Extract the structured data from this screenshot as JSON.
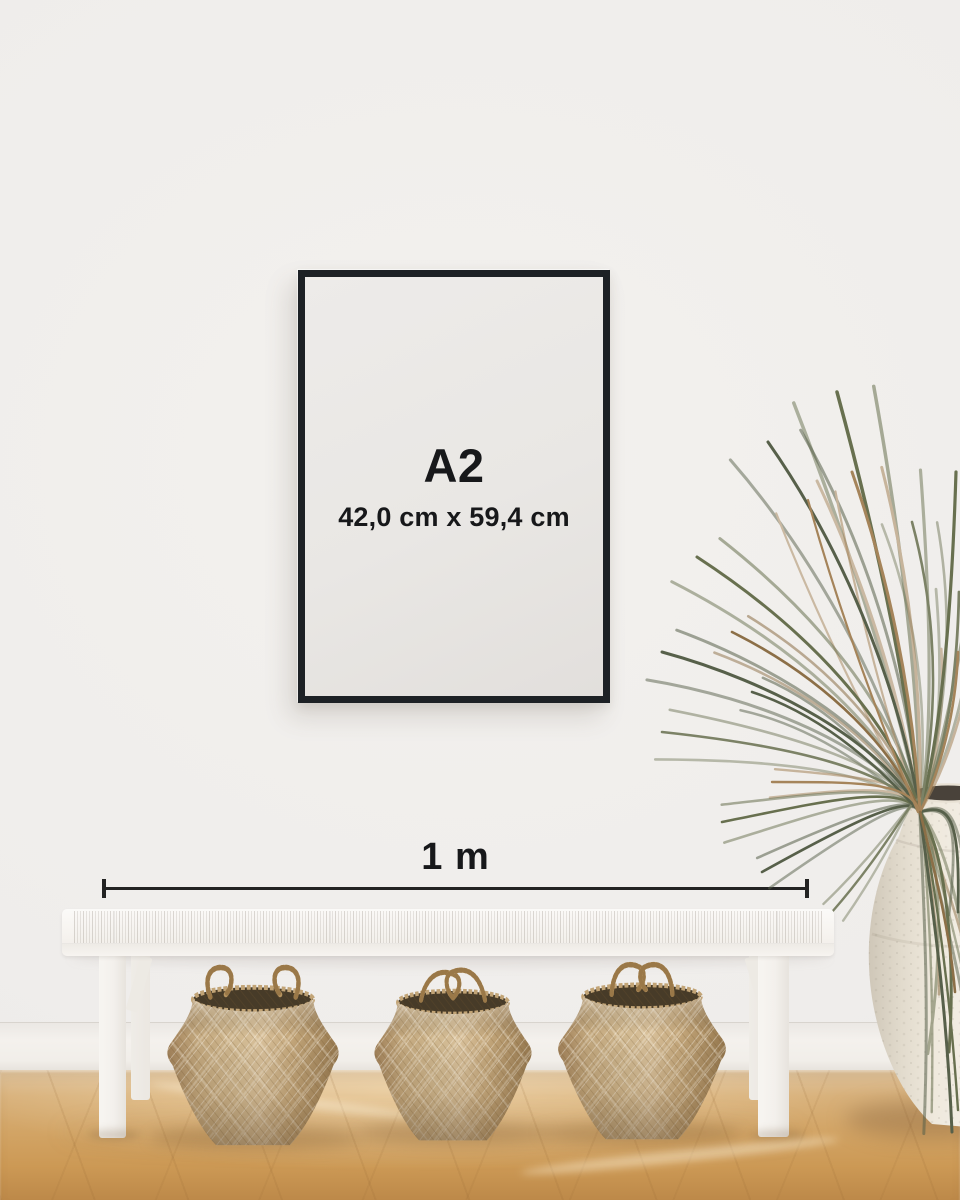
{
  "poster": {
    "size_label": "A2",
    "dimensions_label": "42,0 cm x 59,4 cm"
  },
  "measurement": {
    "label": "1 m"
  },
  "colors": {
    "frame": "#1d2125",
    "ink": "#17181a",
    "ruler": "#232323",
    "wall": "#efedea",
    "floor": "#d2a465",
    "bench": "#f6f3ef",
    "basket": "#c3a87e",
    "vase": "#efe9dd",
    "plant_green": "#68704f",
    "plant_brown": "#a5845a"
  }
}
